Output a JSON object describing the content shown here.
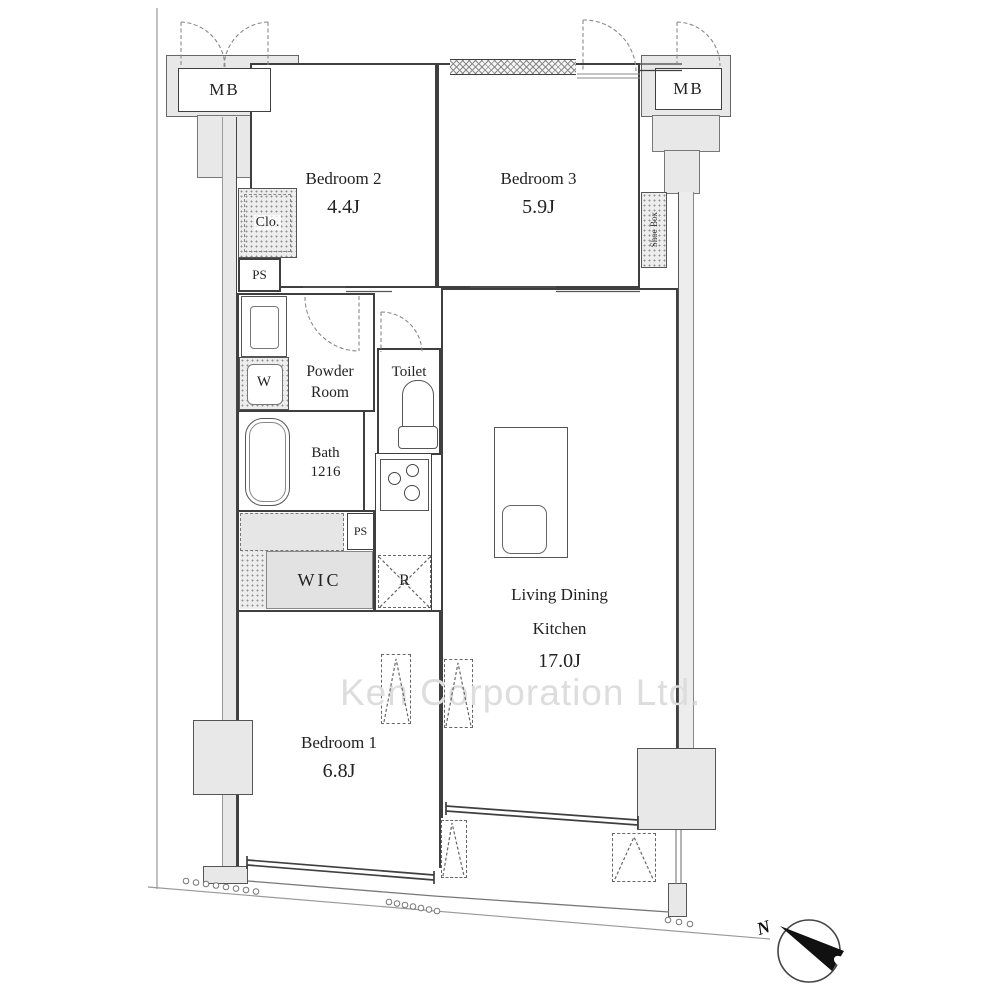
{
  "watermark": "Ken Corporation Ltd.",
  "compass": {
    "label": "N"
  },
  "rooms": {
    "bedroom2": {
      "name": "Bedroom 2",
      "area": "4.4J"
    },
    "bedroom3": {
      "name": "Bedroom 3",
      "area": "5.9J"
    },
    "bedroom1": {
      "name": "Bedroom 1",
      "area": "6.8J"
    },
    "ldk": {
      "line1": "Living Dining",
      "line2": "Kitchen",
      "area": "17.0J"
    },
    "powder_room": {
      "line1": "Powder",
      "line2": "Room"
    },
    "toilet": {
      "name": "Toilet"
    },
    "bath": {
      "name": "Bath",
      "size": "1216"
    },
    "wic": {
      "name": "WIC"
    },
    "closet": {
      "name": "Clo."
    },
    "shoe_box": {
      "name": "Shoe Box"
    }
  },
  "fixtures": {
    "meter_box_left": "MB",
    "meter_box_right": "MB",
    "pipe_space_upper": "PS",
    "pipe_space_lower": "PS",
    "washer": "W",
    "refrigerator": "R"
  }
}
